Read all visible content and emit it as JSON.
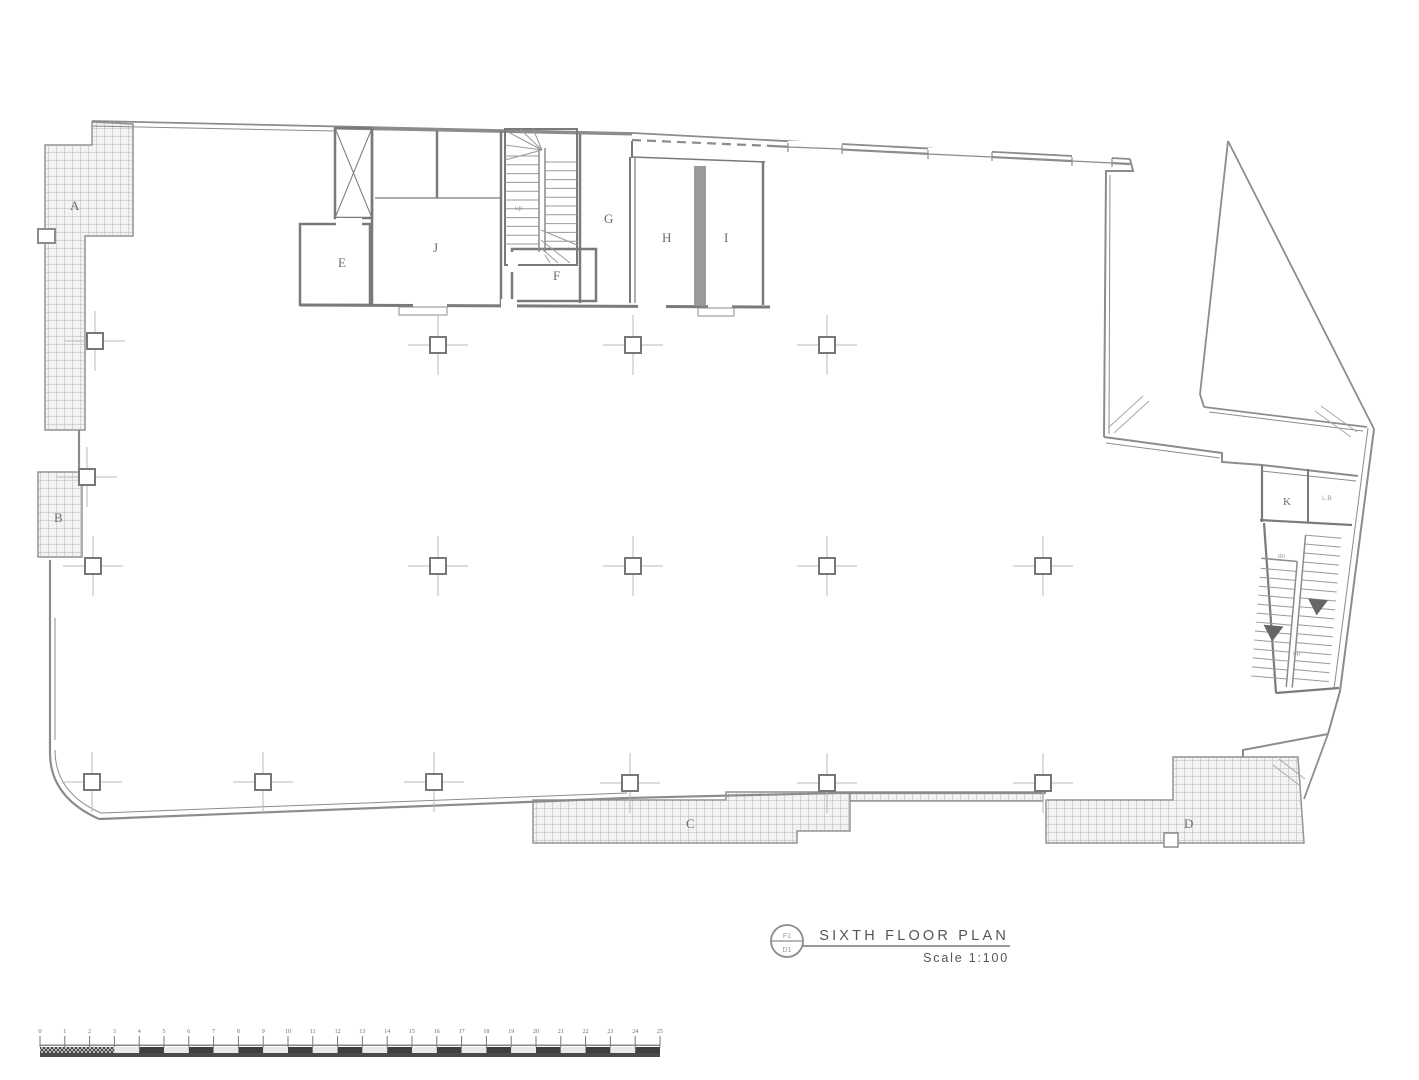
{
  "title_block": {
    "ref_circle_top": "F1",
    "ref_circle_bottom": "D1",
    "title": "SIXTH  FLOOR  PLAN",
    "scale": "Scale  1:100"
  },
  "plan_labels": {
    "A": "A",
    "B": "B",
    "C": "C",
    "D": "D",
    "E": "E",
    "F": "F",
    "G": "G",
    "H": "H",
    "I": "I",
    "J": "J",
    "K": "K",
    "lift_room": "L.B",
    "stair1_up": "up",
    "stair2_dn": "dn",
    "stair2_up": "up"
  },
  "scale_bar": {
    "unit_labels": [
      "0",
      "1",
      "2",
      "3",
      "4",
      "5",
      "6",
      "7",
      "8",
      "9",
      "10",
      "11",
      "12",
      "13",
      "14",
      "15",
      "16",
      "17",
      "18",
      "19",
      "20",
      "21",
      "22",
      "23",
      "24",
      "25"
    ]
  },
  "colors": {
    "wall": "#8c8c8c",
    "partition": "#7a7a7a",
    "hatch_line": "#b4b4b4",
    "hatch_fill": "#f3f3f3",
    "text": "#6b6b6b",
    "title_text": "#555555"
  }
}
